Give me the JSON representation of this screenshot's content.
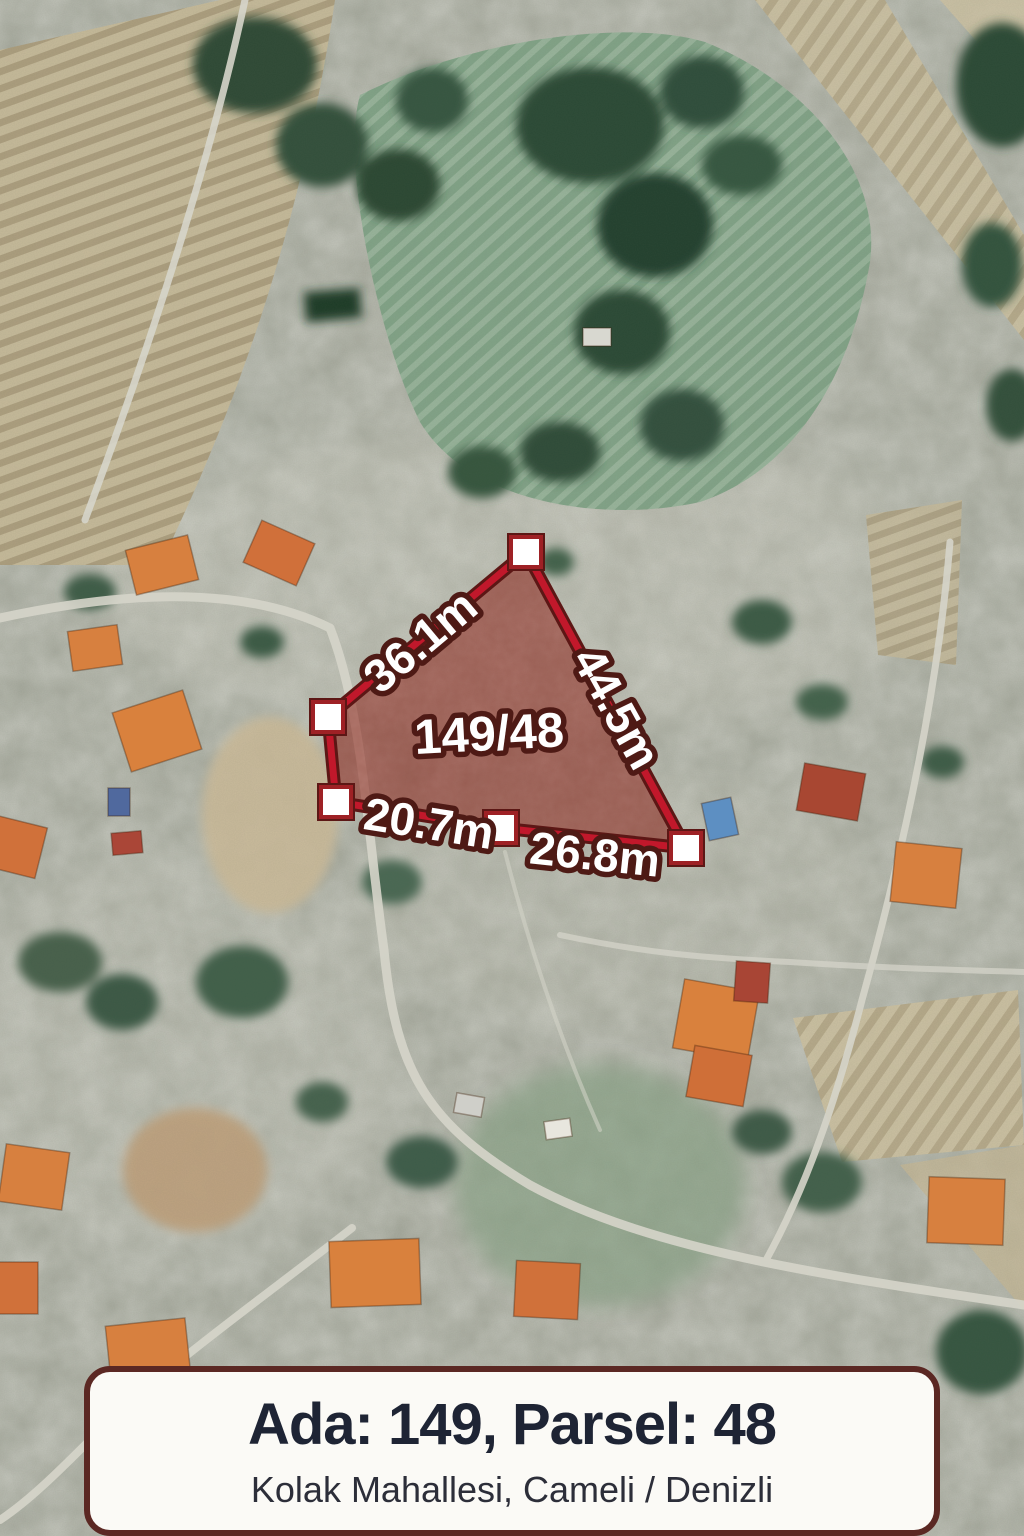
{
  "map_overlay": {
    "parcel_label": "149/48",
    "edge_labels": [
      {
        "side": "top-left",
        "label": "36.1m"
      },
      {
        "side": "right",
        "label": "44.5m"
      },
      {
        "side": "bottom-left",
        "label": "20.7m"
      },
      {
        "side": "bottom-right",
        "label": "26.8m"
      }
    ]
  },
  "info_card": {
    "title": "Ada: 149, Parsel: 48",
    "subtitle": "Kolak Mahallesi, Cameli / Denizli"
  },
  "colors": {
    "parcel_fill": "rgba(148,44,34,0.55)",
    "parcel_stroke": "#c1182b",
    "parcel_stroke_dark": "#5c1715",
    "label_fill": "#ffffff",
    "label_outline": "#4e1a15",
    "card_bg": "#fbfaf6",
    "card_border": "#5b2823",
    "card_title": "#1e2434",
    "card_subtitle": "#2c2e39"
  }
}
